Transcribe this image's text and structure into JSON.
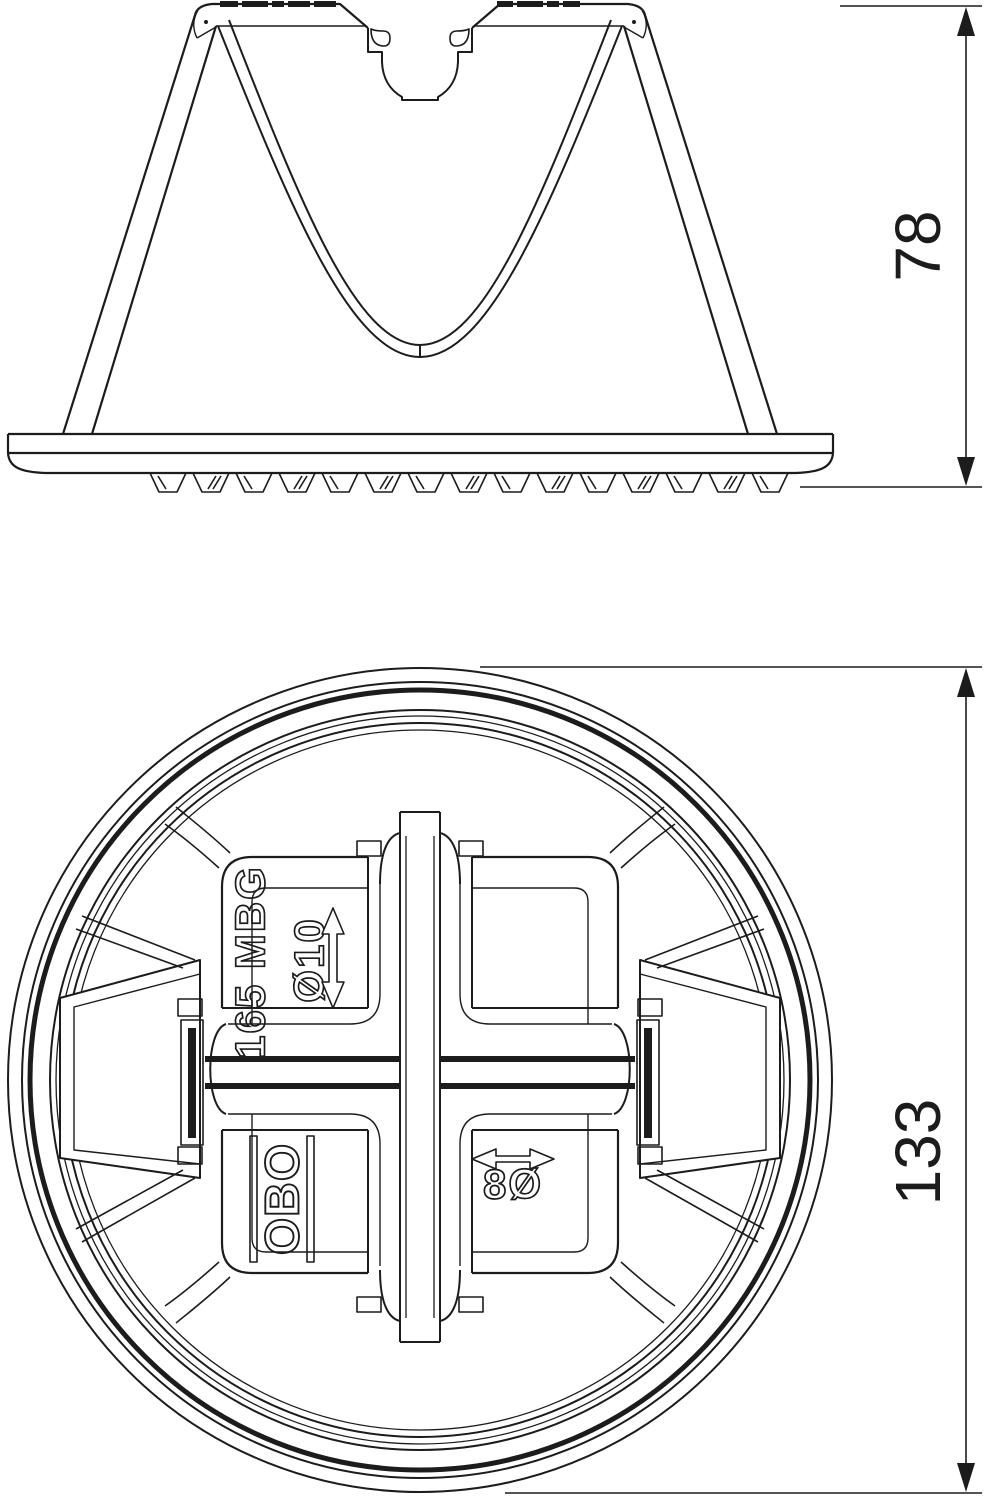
{
  "drawing": {
    "kind": "technical-line-drawing",
    "colors": {
      "line": "#1c1c1c",
      "background": "#ffffff"
    },
    "side_view": {
      "description": "side elevation of conical conductor holder with serrated base plate and central keyhole clamp slot",
      "height_dimension": "78"
    },
    "plan_view": {
      "description": "circular plan view with cross-shaped conductor channels, spring wings and embossed markings",
      "overall_dimension": "133",
      "embossed": {
        "product_label": "165 MBG",
        "top_conductor_diameter": "Ø10",
        "brand": "OBO",
        "bottom_conductor_diameter": "8Ø"
      }
    }
  }
}
